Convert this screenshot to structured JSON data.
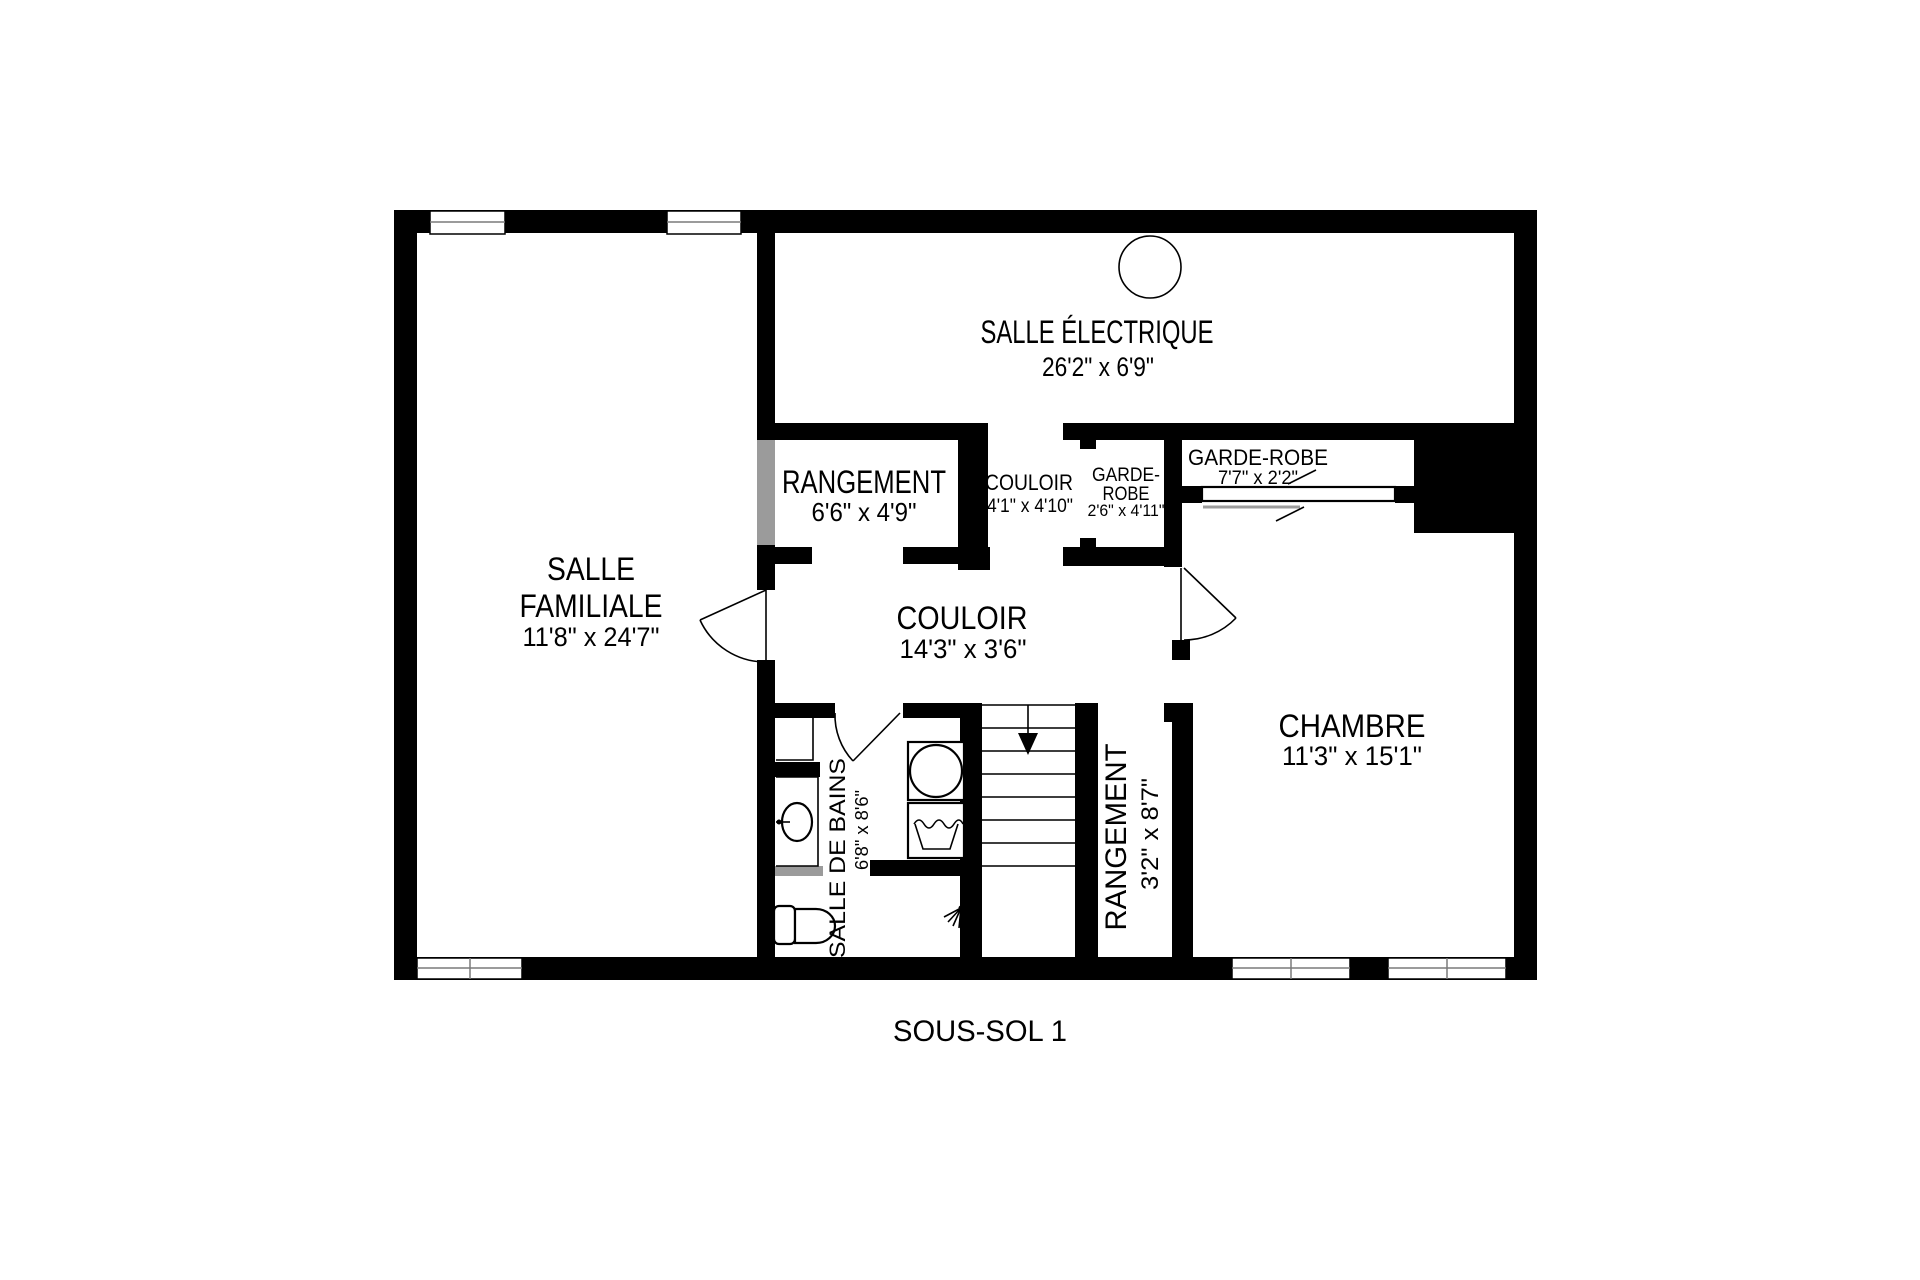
{
  "caption": "SOUS-SOL 1",
  "colors": {
    "wall": "#000000",
    "background": "#ffffff",
    "accent_gray": "#9b9b9b"
  },
  "rooms": {
    "salle_electrique": {
      "name": "SALLE ÉLECTRIQUE",
      "dims": "26'2\" x 6'9\""
    },
    "salle_familiale": {
      "name_line1": "SALLE",
      "name_line2": "FAMILIALE",
      "dims": "11'8\" x 24'7\""
    },
    "rangement_haut": {
      "name": "RANGEMENT",
      "dims": "6'6\" x 4'9\""
    },
    "couloir_petit": {
      "name": "COULOIR",
      "dims": "4'1\" x 4'10\""
    },
    "garde_robe_petit": {
      "name_line1": "GARDE-",
      "name_line2": "ROBE",
      "dims": "2'6\" x 4'11\""
    },
    "garde_robe_long": {
      "name": "GARDE-ROBE",
      "dims": "7'7\" x 2'2\""
    },
    "couloir_principal": {
      "name": "COULOIR",
      "dims": "14'3\" x 3'6\""
    },
    "chambre": {
      "name": "CHAMBRE",
      "dims": "11'3\" x 15'1\""
    },
    "salle_de_bains": {
      "name": "SALLE DE BAINS",
      "dims": "6'8\" x 8'6\""
    },
    "rangement_bas": {
      "name": "RANGEMENT",
      "dims": "3'2\" x 8'7\""
    }
  }
}
